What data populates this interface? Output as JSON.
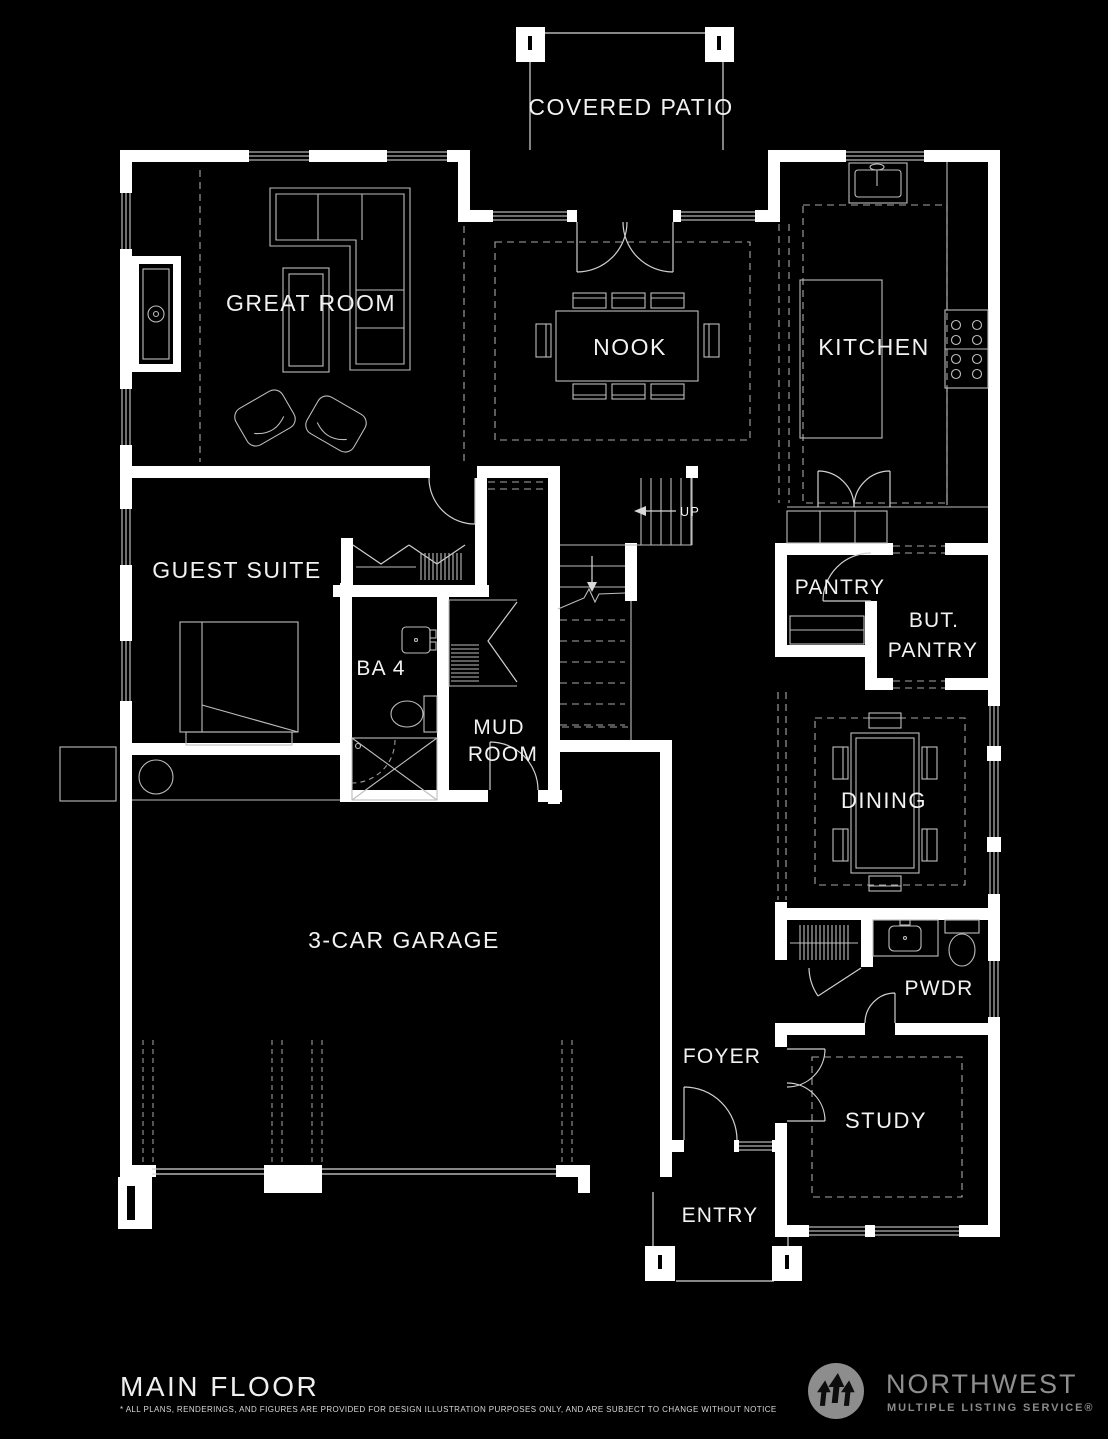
{
  "plan": {
    "rooms": {
      "covered_patio": "COVERED PATIO",
      "great_room": "GREAT ROOM",
      "nook": "NOOK",
      "kitchen": "KITCHEN",
      "guest_suite": "GUEST SUITE",
      "pantry": "PANTRY",
      "butlers_pantry": {
        "line1": "BUT.",
        "line2": "PANTRY"
      },
      "bath4": "BA 4",
      "mud_room": {
        "line1": "MUD",
        "line2": "ROOM"
      },
      "dining": "DINING",
      "garage": "3-CAR GARAGE",
      "powder": "PWDR",
      "foyer": "FOYER",
      "study": "STUDY",
      "entry": "ENTRY"
    },
    "stairs": {
      "up_label": "UP"
    }
  },
  "footer": {
    "title": "MAIN FLOOR",
    "disclaimer": "* ALL PLANS, RENDERINGS, AND FIGURES ARE PROVIDED FOR DESIGN ILLUSTRATION PURPOSES ONLY, AND ARE SUBJECT TO CHANGE WITHOUT NOTICE"
  },
  "logo": {
    "name": "NORTHWEST",
    "tagline": "MULTIPLE LISTING SERVICE®",
    "icon": "nwmls-trees-icon"
  },
  "colors": {
    "background": "#000000",
    "walls": "#ffffff",
    "lines": "#c4c4c4",
    "labels": "#f2f2f2",
    "logo_gray": "#8d8d8d"
  }
}
